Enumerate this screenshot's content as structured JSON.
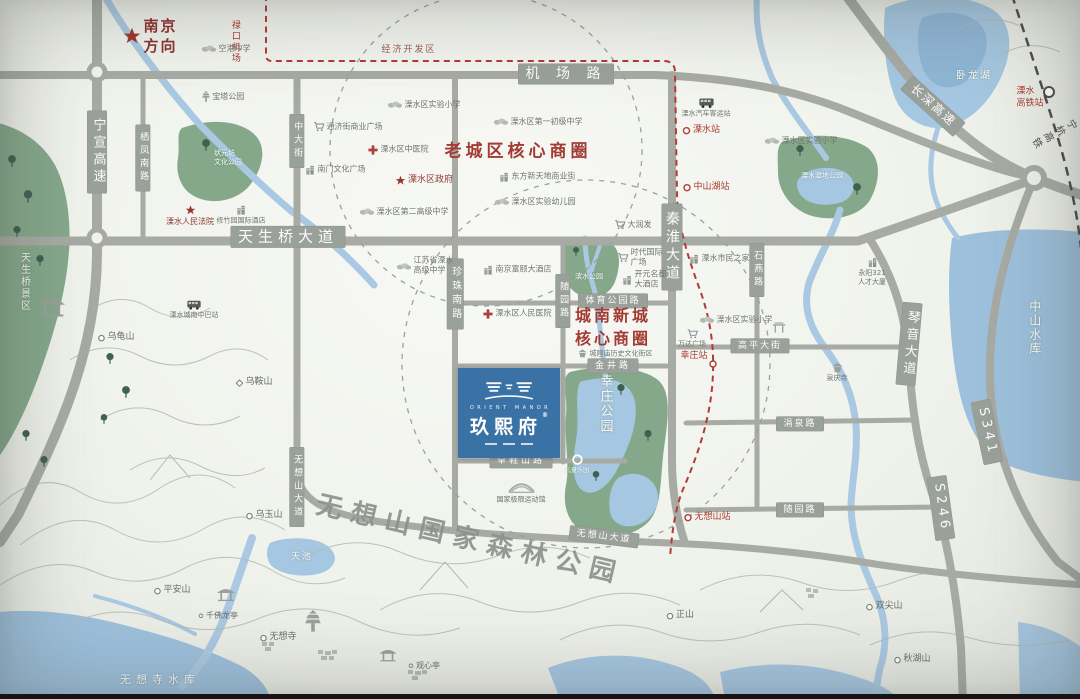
{
  "project": {
    "en": "ORIENT MANOR",
    "cn": "玖熙府",
    "reg": "®"
  },
  "colors": {
    "road": "#a7aba4",
    "plate": "#9aa09a",
    "water": "#a5c7e1",
    "lake": "#9dc0dc",
    "green": "#85a88b",
    "accent_red": "#a23b33",
    "metro_red": "#b23c34",
    "rail_dark": "#4d4d4d",
    "logo_blue": "#3a72a5"
  },
  "plates": [
    {
      "id": "jichang-road",
      "t": "机 场 路",
      "x": 566,
      "y": 74,
      "fs": 14,
      "ls": 6
    },
    {
      "id": "tianshengqiao-avenue",
      "t": "天生桥大道",
      "x": 288,
      "y": 237,
      "fs": 15,
      "ls": 5
    },
    {
      "id": "ningxuan-expressway",
      "t": "宁宣高速",
      "x": 97,
      "y": 152,
      "fs": 13,
      "v": 1
    },
    {
      "id": "qifeng-south-road",
      "t": "栖凤南路",
      "x": 143,
      "y": 158,
      "fs": 9,
      "v": 1
    },
    {
      "id": "zhongda-street",
      "t": "中大街",
      "x": 297,
      "y": 141,
      "fs": 9,
      "v": 1
    },
    {
      "id": "zhenzhu-south-road",
      "t": "珍珠南路",
      "x": 455,
      "y": 294,
      "fs": 10,
      "v": 1
    },
    {
      "id": "suiyuan-road-v",
      "t": "随园路",
      "x": 563,
      "y": 301,
      "fs": 9,
      "v": 1
    },
    {
      "id": "qinhuai-avenue",
      "t": "秦淮大道",
      "x": 672,
      "y": 247,
      "fs": 14,
      "v": 1
    },
    {
      "id": "shiyan-road",
      "t": "石燕路",
      "x": 757,
      "y": 270,
      "fs": 9,
      "v": 1
    },
    {
      "id": "sports-park-road",
      "t": "体育公园路",
      "x": 613,
      "y": 301,
      "fs": 9,
      "ls": 2
    },
    {
      "id": "jinjing-road",
      "t": "金井路",
      "x": 613,
      "y": 366,
      "fs": 9,
      "ls": 3
    },
    {
      "id": "caoxieshan-road",
      "t": "草鞋山路",
      "x": 521,
      "y": 461,
      "fs": 9,
      "ls": 3
    },
    {
      "id": "gaoping-street",
      "t": "高平大街",
      "x": 760,
      "y": 346,
      "fs": 9,
      "ls": 2
    },
    {
      "id": "juanquan-road",
      "t": "涓泉路",
      "x": 800,
      "y": 424,
      "fs": 9,
      "ls": 2
    },
    {
      "id": "suiyuan-road-h",
      "t": "随园路",
      "x": 800,
      "y": 510,
      "fs": 9,
      "ls": 2
    },
    {
      "id": "wuxiangshan-avenue-v",
      "t": "无想山大道",
      "x": 297,
      "y": 487,
      "fs": 9,
      "v": 1
    },
    {
      "id": "wuxiangshan-avenue-h",
      "t": "无想山大道",
      "x": 604,
      "y": 537,
      "fs": 9,
      "ls": 2,
      "rot": 7
    },
    {
      "id": "qinyin-avenue",
      "t": "琴音大道",
      "x": 909,
      "y": 344,
      "fs": 13,
      "v": 1,
      "rot": 5
    },
    {
      "id": "changshen-expressway",
      "t": "长深高速",
      "x": 933,
      "y": 106,
      "fs": 12,
      "rot": 42,
      "ls": 2
    },
    {
      "id": "s341-shield",
      "t": "S341",
      "x": 987,
      "y": 432,
      "fs": 13,
      "rot": 78
    },
    {
      "id": "s246-shield",
      "t": "S246",
      "x": 941,
      "y": 508,
      "fs": 13,
      "rot": 82
    }
  ],
  "labels": [
    {
      "id": "nanjing-direction",
      "t": "南京\n方向",
      "x": 150,
      "y": 36,
      "cls": "dir",
      "icon": "star",
      "is": 19,
      "fs": 15,
      "ls": 2
    },
    {
      "id": "lukou-airport",
      "t": "禄口机场",
      "x": 234,
      "y": 42,
      "cls": "red",
      "fs": 9,
      "v": 1
    },
    {
      "id": "economic-zone",
      "t": "经济开发区",
      "x": 409,
      "y": 51,
      "cls": "red2",
      "fs": 9,
      "ls": 2
    },
    {
      "id": "konggang-middle-school",
      "t": "空港中学",
      "x": 226,
      "y": 49,
      "icon": "treeg",
      "fs": 8
    },
    {
      "id": "baota-park",
      "t": "宝塔公园",
      "x": 223,
      "y": 97,
      "icon": "pagoda",
      "is": 12,
      "fs": 8
    },
    {
      "id": "zhuangyuanfang-park",
      "t": "状元坊\n文化公园",
      "x": 228,
      "y": 158,
      "cls": "wt",
      "fs": 7
    },
    {
      "id": "lishui-experimental-primary-1",
      "t": "溧水区实验小学",
      "x": 424,
      "y": 105,
      "icon": "treeg",
      "fs": 8
    },
    {
      "id": "lishui-no1-junior-middle",
      "t": "溧水区第一初级中学",
      "x": 538,
      "y": 122,
      "icon": "treeg",
      "fs": 8
    },
    {
      "id": "old-town-core-zone",
      "t": "老城区核心商圈",
      "x": 518,
      "y": 152,
      "cls": "zone",
      "fs": 17,
      "ls": 4
    },
    {
      "id": "dongfang-xintiandi",
      "t": "东方新天地商业街",
      "x": 537,
      "y": 177,
      "icon": "bld",
      "fs": 8
    },
    {
      "id": "lishui-experimental-kindergarten",
      "t": "溧水区实验幼儿园",
      "x": 535,
      "y": 202,
      "icon": "treeg",
      "fs": 8
    },
    {
      "id": "tongjijie-plaza",
      "t": "通济街商业广场",
      "x": 348,
      "y": 127,
      "icon": "cart",
      "fs": 8
    },
    {
      "id": "lishui-tcm-hospital",
      "t": "溧水区中医院",
      "x": 398,
      "y": 150,
      "icon": "cross",
      "fs": 8
    },
    {
      "id": "nanmen-culture-plaza",
      "t": "南门文化广场",
      "x": 335,
      "y": 170,
      "icon": "bld",
      "fs": 8
    },
    {
      "id": "lishui-district-government",
      "t": "溧水区政府",
      "x": 424,
      "y": 181,
      "cls": "gov",
      "icon": "star",
      "is": 11,
      "fs": 9
    },
    {
      "id": "lishui-no2-senior-middle",
      "t": "溧水区第二高级中学",
      "x": 404,
      "y": 212,
      "icon": "treeg",
      "fs": 8
    },
    {
      "id": "lishui-people-court",
      "t": "溧水人民法院",
      "x": 190,
      "y": 216,
      "cls": "gov col",
      "icon": "star",
      "is": 11,
      "fs": 8
    },
    {
      "id": "xiuzhuyuan-hotel",
      "t": "修竹园国际酒店",
      "x": 241,
      "y": 215,
      "cls": "col",
      "icon": "bld",
      "fs": 7
    },
    {
      "id": "jiangsu-lishui-senior-middle",
      "t": "江苏省溧水\n高级中学",
      "x": 425,
      "y": 266,
      "icon": "treeg",
      "fs": 8
    },
    {
      "id": "nanjing-fuyi-hotel",
      "t": "南京富颐大酒店",
      "x": 517,
      "y": 270,
      "icon": "bld",
      "fs": 8
    },
    {
      "id": "lishui-people-hospital",
      "t": "溧水区人民医院",
      "x": 517,
      "y": 314,
      "icon": "cross",
      "fs": 8
    },
    {
      "id": "darunfa-supermarket",
      "t": "大润发",
      "x": 633,
      "y": 225,
      "icon": "cart",
      "fs": 8
    },
    {
      "id": "shidai-intl-plaza",
      "t": "时代国际\n广场",
      "x": 640,
      "y": 258,
      "icon": "cart",
      "fs": 8
    },
    {
      "id": "kaiyuan-mingdu-hotel",
      "t": "开元名都\n大酒店",
      "x": 644,
      "y": 280,
      "icon": "bld",
      "fs": 8
    },
    {
      "id": "binshui-park",
      "t": "滨水公园",
      "x": 589,
      "y": 277,
      "cls": "wt",
      "fs": 7
    },
    {
      "id": "chengnan-core-zone",
      "t": "城南新城\n核心商圈",
      "x": 613,
      "y": 327,
      "cls": "zone",
      "fs": 16,
      "ls": 3
    },
    {
      "id": "lishui-bus-terminal",
      "t": "溧水汽车客运站",
      "x": 706,
      "y": 108,
      "cls": "col",
      "icon": "bus",
      "is": 16,
      "fs": 7
    },
    {
      "id": "lishui-metro-station",
      "t": "溧水站",
      "x": 701,
      "y": 131,
      "cls": "red",
      "icon": "station",
      "is": 9,
      "fs": 9
    },
    {
      "id": "zhongshanhu-station",
      "t": "中山湖站",
      "x": 706,
      "y": 188,
      "cls": "red",
      "icon": "station",
      "is": 9,
      "fs": 9
    },
    {
      "id": "shidi-park",
      "t": "溧水湿地公园",
      "x": 822,
      "y": 176,
      "cls": "wt",
      "fs": 7
    },
    {
      "id": "lishui-experimental-primary-2",
      "t": "溧水区实验小学",
      "x": 801,
      "y": 141,
      "icon": "treeg",
      "fs": 8
    },
    {
      "id": "lishui-citizen-center",
      "t": "溧水市民之家",
      "x": 719,
      "y": 259,
      "icon": "bld",
      "fs": 8
    },
    {
      "id": "yongyang-321-tower",
      "t": "永阳321\n人才大厦",
      "x": 872,
      "y": 272,
      "cls": "col",
      "icon": "bld",
      "fs": 7
    },
    {
      "id": "lishui-experimental-primary-3",
      "t": "溧水区实验小学",
      "x": 736,
      "y": 320,
      "icon": "treeg",
      "fs": 8
    },
    {
      "id": "wanda-plaza",
      "t": "万达广场",
      "x": 692,
      "y": 339,
      "cls": "col",
      "icon": "cart",
      "fs": 7
    },
    {
      "id": "xingzhuang-station",
      "t": "幸庄站",
      "x": 694,
      "y": 357,
      "cls": "red",
      "fs": 9
    },
    {
      "id": "chenghuangmiao-block",
      "t": "城隍庙历史文化街区",
      "x": 615,
      "y": 354,
      "icon": "temple",
      "is": 10,
      "fs": 7
    },
    {
      "id": "xingzhuang-park",
      "t": "幸庄公园",
      "x": 604,
      "y": 404,
      "cls": "wt",
      "v": 1,
      "fs": 13,
      "ls": 5
    },
    {
      "id": "kids-paradise",
      "t": "儿童乐园",
      "x": 577,
      "y": 464,
      "cls": "wt col",
      "icon": "ringw",
      "is": 13,
      "fs": 6
    },
    {
      "id": "quanqing-temple",
      "t": "泉庆寺",
      "x": 837,
      "y": 373,
      "cls": "col",
      "icon": "temple",
      "is": 12,
      "fs": 7
    },
    {
      "id": "national-extreme-sports-hall",
      "t": "国家极限运动馆",
      "x": 521,
      "y": 493,
      "cls": "col",
      "icon": "stadium",
      "fs": 7
    },
    {
      "id": "lishui-chengnan-midibus",
      "t": "溧水城南中巴站",
      "x": 194,
      "y": 310,
      "cls": "col",
      "icon": "bus",
      "is": 15,
      "fs": 7
    },
    {
      "id": "tianshengqiao-scenic",
      "t": "天生桥景区",
      "x": 24,
      "y": 282,
      "cls": "wt",
      "v": 1,
      "fs": 10,
      "ls": 4
    },
    {
      "id": "wugui-mountain",
      "t": "乌龟山",
      "x": 116,
      "y": 338,
      "icon": "circ",
      "is": 8,
      "fs": 9,
      "cls": "mt"
    },
    {
      "id": "wuan-mountain",
      "t": "乌鞍山",
      "x": 254,
      "y": 383,
      "icon": "diam",
      "is": 8,
      "fs": 9,
      "cls": "mt"
    },
    {
      "id": "wuyu-mountain",
      "t": "乌玉山",
      "x": 264,
      "y": 516,
      "icon": "circ",
      "is": 8,
      "fs": 9,
      "cls": "mt"
    },
    {
      "id": "pingan-mountain",
      "t": "平安山",
      "x": 172,
      "y": 591,
      "icon": "circ",
      "is": 8,
      "fs": 9,
      "cls": "mt"
    },
    {
      "id": "qianfo-pavilion",
      "t": "千佛龙亭",
      "x": 218,
      "y": 616,
      "icon": "dot",
      "is": 6,
      "fs": 8,
      "cls": "mt"
    },
    {
      "id": "tianchi-pond",
      "t": "天池",
      "x": 302,
      "y": 558,
      "cls": "wt",
      "fs": 9,
      "ls": 2
    },
    {
      "id": "wuxiang-temple",
      "t": "无想寺",
      "x": 278,
      "y": 638,
      "icon": "circ",
      "is": 8,
      "fs": 9,
      "cls": "mt"
    },
    {
      "id": "guanxin-pavilion",
      "t": "观心亭",
      "x": 424,
      "y": 666,
      "icon": "dot",
      "is": 6,
      "fs": 8,
      "cls": "mt"
    },
    {
      "id": "zheng-mountain",
      "t": "正山",
      "x": 680,
      "y": 616,
      "icon": "circ",
      "is": 8,
      "fs": 9,
      "cls": "mt"
    },
    {
      "id": "shuangjian-mountain",
      "t": "双尖山",
      "x": 884,
      "y": 607,
      "icon": "circ",
      "is": 8,
      "fs": 9,
      "cls": "mt"
    },
    {
      "id": "qiuhu-mountain",
      "t": "秋湖山",
      "x": 912,
      "y": 660,
      "icon": "circ",
      "is": 8,
      "fs": 9,
      "cls": "mt"
    },
    {
      "id": "wuxiangsi-reservoir",
      "t": "无想寺水库",
      "x": 160,
      "y": 680,
      "cls": "wt",
      "fs": 11,
      "ls": 5
    },
    {
      "id": "wolong-lake",
      "t": "卧龙湖",
      "x": 974,
      "y": 76,
      "cls": "wt",
      "fs": 10,
      "ls": 2
    },
    {
      "id": "zhongshan-reservoir",
      "t": "中山水库",
      "x": 1034,
      "y": 328,
      "cls": "wt",
      "v": 1,
      "fs": 12,
      "ls": 5
    },
    {
      "id": "lishui-hsr-station",
      "t": "溧水\n高铁站",
      "x": 1030,
      "y": 98,
      "cls": "red",
      "fs": 9
    },
    {
      "id": "ninghang-hsr",
      "t": "宁杭高铁",
      "x": 1057,
      "y": 140,
      "cls": "dk",
      "fs": 10,
      "rot": 62,
      "ls": 2
    },
    {
      "id": "wuxiangshan-station",
      "t": "无想山站",
      "x": 707,
      "y": 518,
      "cls": "red",
      "icon": "station",
      "is": 9,
      "fs": 9
    },
    {
      "id": "wuxiangshan-forest-park",
      "t": "无想山国家森林公园",
      "x": 470,
      "y": 541,
      "cls": "forest",
      "fs": 26,
      "rot": 13,
      "ls": 9
    }
  ],
  "deco": [
    {
      "icon": "pavilion",
      "x": 52,
      "y": 310,
      "s": 26
    },
    {
      "icon": "pavilion",
      "x": 226,
      "y": 596,
      "s": 18
    },
    {
      "icon": "pavilion",
      "x": 388,
      "y": 657,
      "s": 17
    },
    {
      "icon": "pagoda",
      "x": 313,
      "y": 624,
      "s": 24
    },
    {
      "icon": "paifang",
      "x": 779,
      "y": 327,
      "s": 14
    },
    {
      "icon": "station",
      "x": 713,
      "y": 363,
      "s": 9
    },
    {
      "icon": "treeG",
      "x": 206,
      "y": 146,
      "s": 13
    },
    {
      "icon": "treeG",
      "x": 800,
      "y": 151,
      "s": 12
    },
    {
      "icon": "treeG",
      "x": 857,
      "y": 190,
      "s": 13
    },
    {
      "icon": "treeG",
      "x": 621,
      "y": 390,
      "s": 12
    },
    {
      "icon": "treeG",
      "x": 648,
      "y": 436,
      "s": 12
    },
    {
      "icon": "treeG",
      "x": 596,
      "y": 476,
      "s": 11
    },
    {
      "icon": "treeG",
      "x": 576,
      "y": 251,
      "s": 10
    },
    {
      "icon": "treeG",
      "x": 12,
      "y": 162,
      "s": 13
    },
    {
      "icon": "treeG",
      "x": 28,
      "y": 198,
      "s": 14
    },
    {
      "icon": "treeG",
      "x": 17,
      "y": 232,
      "s": 12
    },
    {
      "icon": "treeG",
      "x": 40,
      "y": 261,
      "s": 12
    },
    {
      "icon": "treeG",
      "x": 110,
      "y": 359,
      "s": 12
    },
    {
      "icon": "treeG",
      "x": 126,
      "y": 393,
      "s": 13
    },
    {
      "icon": "treeG",
      "x": 104,
      "y": 419,
      "s": 11
    },
    {
      "icon": "treeG",
      "x": 26,
      "y": 436,
      "s": 12
    },
    {
      "icon": "treeG",
      "x": 44,
      "y": 462,
      "s": 12
    }
  ]
}
